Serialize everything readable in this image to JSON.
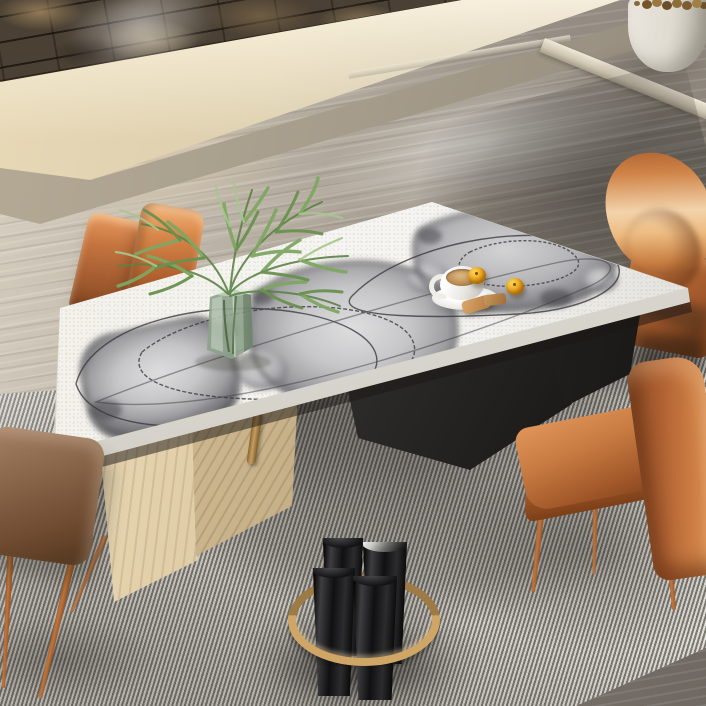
{
  "meta": {
    "type": "photograph",
    "description": "Modern dining room seen from above: stacked-stone accent wall and travertine steps at top, polished concrete floor, long white stone dining table with abstract grey watercolor motif, green glass vase with palm fronds, coffee cup with kumquats and biscuits, tan leather chairs, brown leather stool, grey pinstripe rug, and a cluster of glossy black vases bound by a brass ring"
  },
  "palette": {
    "stone_wall": "#4a4033",
    "step_cream": "#e7d8b6",
    "concrete_pot": "#e9e5dc",
    "table_top": "#f6f5f1",
    "art_gray": "#77777b",
    "art_line": "#3a3a40",
    "leather_orange": "#c0713c",
    "leather_brown": "#8a674a",
    "wood_light": "#ecdcba",
    "wood_shadow": "#d6c39c",
    "base_black": "#121110",
    "brass": "#c49e62",
    "rug_light": "#edebe6",
    "rug_dark": "#7d7870",
    "glass_green": "#8fa88b",
    "leaf_green": "#6f9a58",
    "coffee": "#bb8c55",
    "fruit_orange": "#eda920",
    "biscuit": "#dba76a",
    "cylinder_black": "#101012",
    "cylinder_sheen": "#f4f4f2"
  },
  "objects": {
    "wall": {
      "label": "stacked stone accent wall"
    },
    "steps": {
      "label": "travertine steps and ledge"
    },
    "planter": {
      "label": "white cylindrical planter with dried stems"
    },
    "floor": {
      "label": "polished concrete floor"
    },
    "rug": {
      "label": "grey pinstripe area rug"
    },
    "table": {
      "label": "dining table with white stone top and abstract grey brush art"
    },
    "table_base_black": {
      "label": "black sculptural table base"
    },
    "table_legs_wood": {
      "label": "angled light-wood table legs"
    },
    "table_leg_brass": {
      "label": "brass table leg"
    },
    "vase": {
      "label": "green glass vase with palm fronds"
    },
    "coffee_cup": {
      "label": "white coffee cup on saucer"
    },
    "fruits": {
      "label": "two kumquats"
    },
    "biscuits": {
      "label": "biscuits beside the cup"
    },
    "chair_pair_back": {
      "label": "pair of tan leather chairs behind table"
    },
    "chair_top_right": {
      "label": "tan leather chair, top right"
    },
    "chair_bottom_right": {
      "label": "tan leather chair, bottom right"
    },
    "stool_bottom_left": {
      "label": "brown leather stool, bottom left"
    },
    "black_vases": {
      "label": "cluster of black vases with brass ring"
    }
  }
}
